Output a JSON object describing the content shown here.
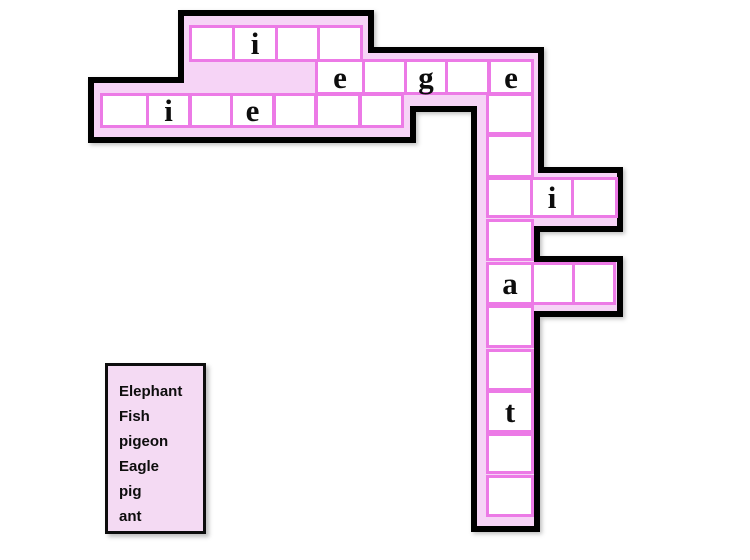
{
  "puzzle": {
    "kind": "animal crossword",
    "grid": {
      "fish_row": [
        "",
        "i",
        "",
        ""
      ],
      "eagle_row": [
        "e",
        "",
        "g",
        "",
        "e"
      ],
      "pigeon_row": [
        "",
        "i",
        "",
        "e",
        "",
        "",
        ""
      ],
      "elephant_column": [
        "e",
        "",
        "",
        "",
        "",
        "a",
        "",
        "",
        "t",
        "",
        ""
      ],
      "pig_row": [
        "",
        "i",
        ""
      ],
      "ant_row": [
        "a",
        "",
        ""
      ]
    }
  },
  "word_list": [
    "Elephant",
    "Fish",
    "pigeon",
    "Eagle",
    "pig",
    "ant"
  ],
  "colors": {
    "background": "#ffffff",
    "puzzle_fill": "#f6d4f6",
    "cell_fill": "#ffffff",
    "cell_border": "#ec7ae6",
    "outline": "#000000",
    "wordbox_fill": "#f4daf3",
    "text": "#0d0d0d"
  }
}
